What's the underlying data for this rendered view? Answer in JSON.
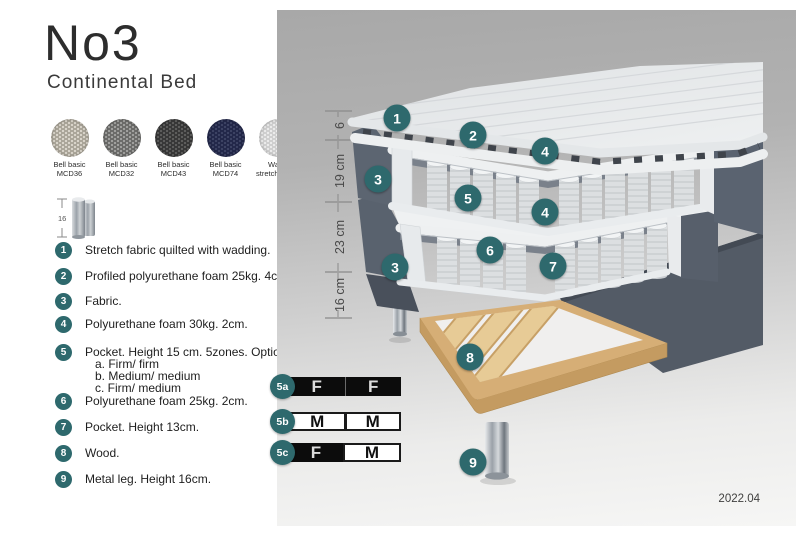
{
  "title": "No3",
  "subtitle": "Continental Bed",
  "colors": {
    "accent_teal": "#2e696d",
    "fabric_gray": "#5a6370",
    "wood": "#d6ae76",
    "table_cell_dark": "#0c0c0c",
    "table_cell_light": "#ffffff"
  },
  "swatches": [
    {
      "line1": "Bell basic",
      "line2": "MCD36",
      "base": "#d9d4ca",
      "dot": "#aba69a"
    },
    {
      "line1": "Bell basic",
      "line2": "MCD32",
      "base": "#a0a09e",
      "dot": "#6c6c6a"
    },
    {
      "line1": "Bell basic",
      "line2": "MCD43",
      "base": "#5d5d5c",
      "dot": "#383838"
    },
    {
      "line1": "Bell basic",
      "line2": "MCD74",
      "base": "#3c4263",
      "dot": "#23284a"
    },
    {
      "line1": "Wave",
      "line2": "stretch fabric",
      "base": "#ebebeb",
      "dot": "#cfcfcf"
    }
  ],
  "leg_icon": {
    "dimension": "16"
  },
  "legend": [
    {
      "num": "1",
      "text": "Stretch fabric quilted with wadding."
    },
    {
      "num": "2",
      "text": "Profiled polyurethane foam 25kg. 4cm."
    },
    {
      "num": "3",
      "text": "Fabric."
    },
    {
      "num": "4",
      "text": "Polyurethane foam 30kg. 2cm."
    },
    {
      "num": "5",
      "text": "Pocket. Height 15 cm. 5zones. Option:",
      "options": [
        "a. Firm/ firm",
        "b. Medium/ medium",
        "c. Firm/ medium"
      ]
    },
    {
      "num": "6",
      "text": "Polyurethane foam 25kg. 2cm."
    },
    {
      "num": "7",
      "text": "Pocket. Height 13cm."
    },
    {
      "num": "8",
      "text": "Wood."
    },
    {
      "num": "9",
      "text": "Metal leg. Height 16cm."
    }
  ],
  "dimensions": [
    "6",
    "19 cm",
    "23 cm",
    "16 cm"
  ],
  "diagram_callouts": [
    {
      "num": "1"
    },
    {
      "num": "2"
    },
    {
      "num": "4"
    },
    {
      "num": "3"
    },
    {
      "num": "5"
    },
    {
      "num": "4"
    },
    {
      "num": "6"
    },
    {
      "num": "7"
    },
    {
      "num": "3"
    },
    {
      "num": "8"
    },
    {
      "num": "9"
    }
  ],
  "firmness_table": {
    "rows": [
      {
        "badge": "5a",
        "cells": [
          {
            "letter": "F",
            "style": "dark"
          },
          {
            "letter": "F",
            "style": "dark"
          }
        ]
      },
      {
        "badge": "5b",
        "cells": [
          {
            "letter": "M",
            "style": "light"
          },
          {
            "letter": "M",
            "style": "light"
          }
        ]
      },
      {
        "badge": "5c",
        "cells": [
          {
            "letter": "F",
            "style": "dark"
          },
          {
            "letter": "M",
            "style": "light"
          }
        ]
      }
    ]
  },
  "version": "2022.04"
}
